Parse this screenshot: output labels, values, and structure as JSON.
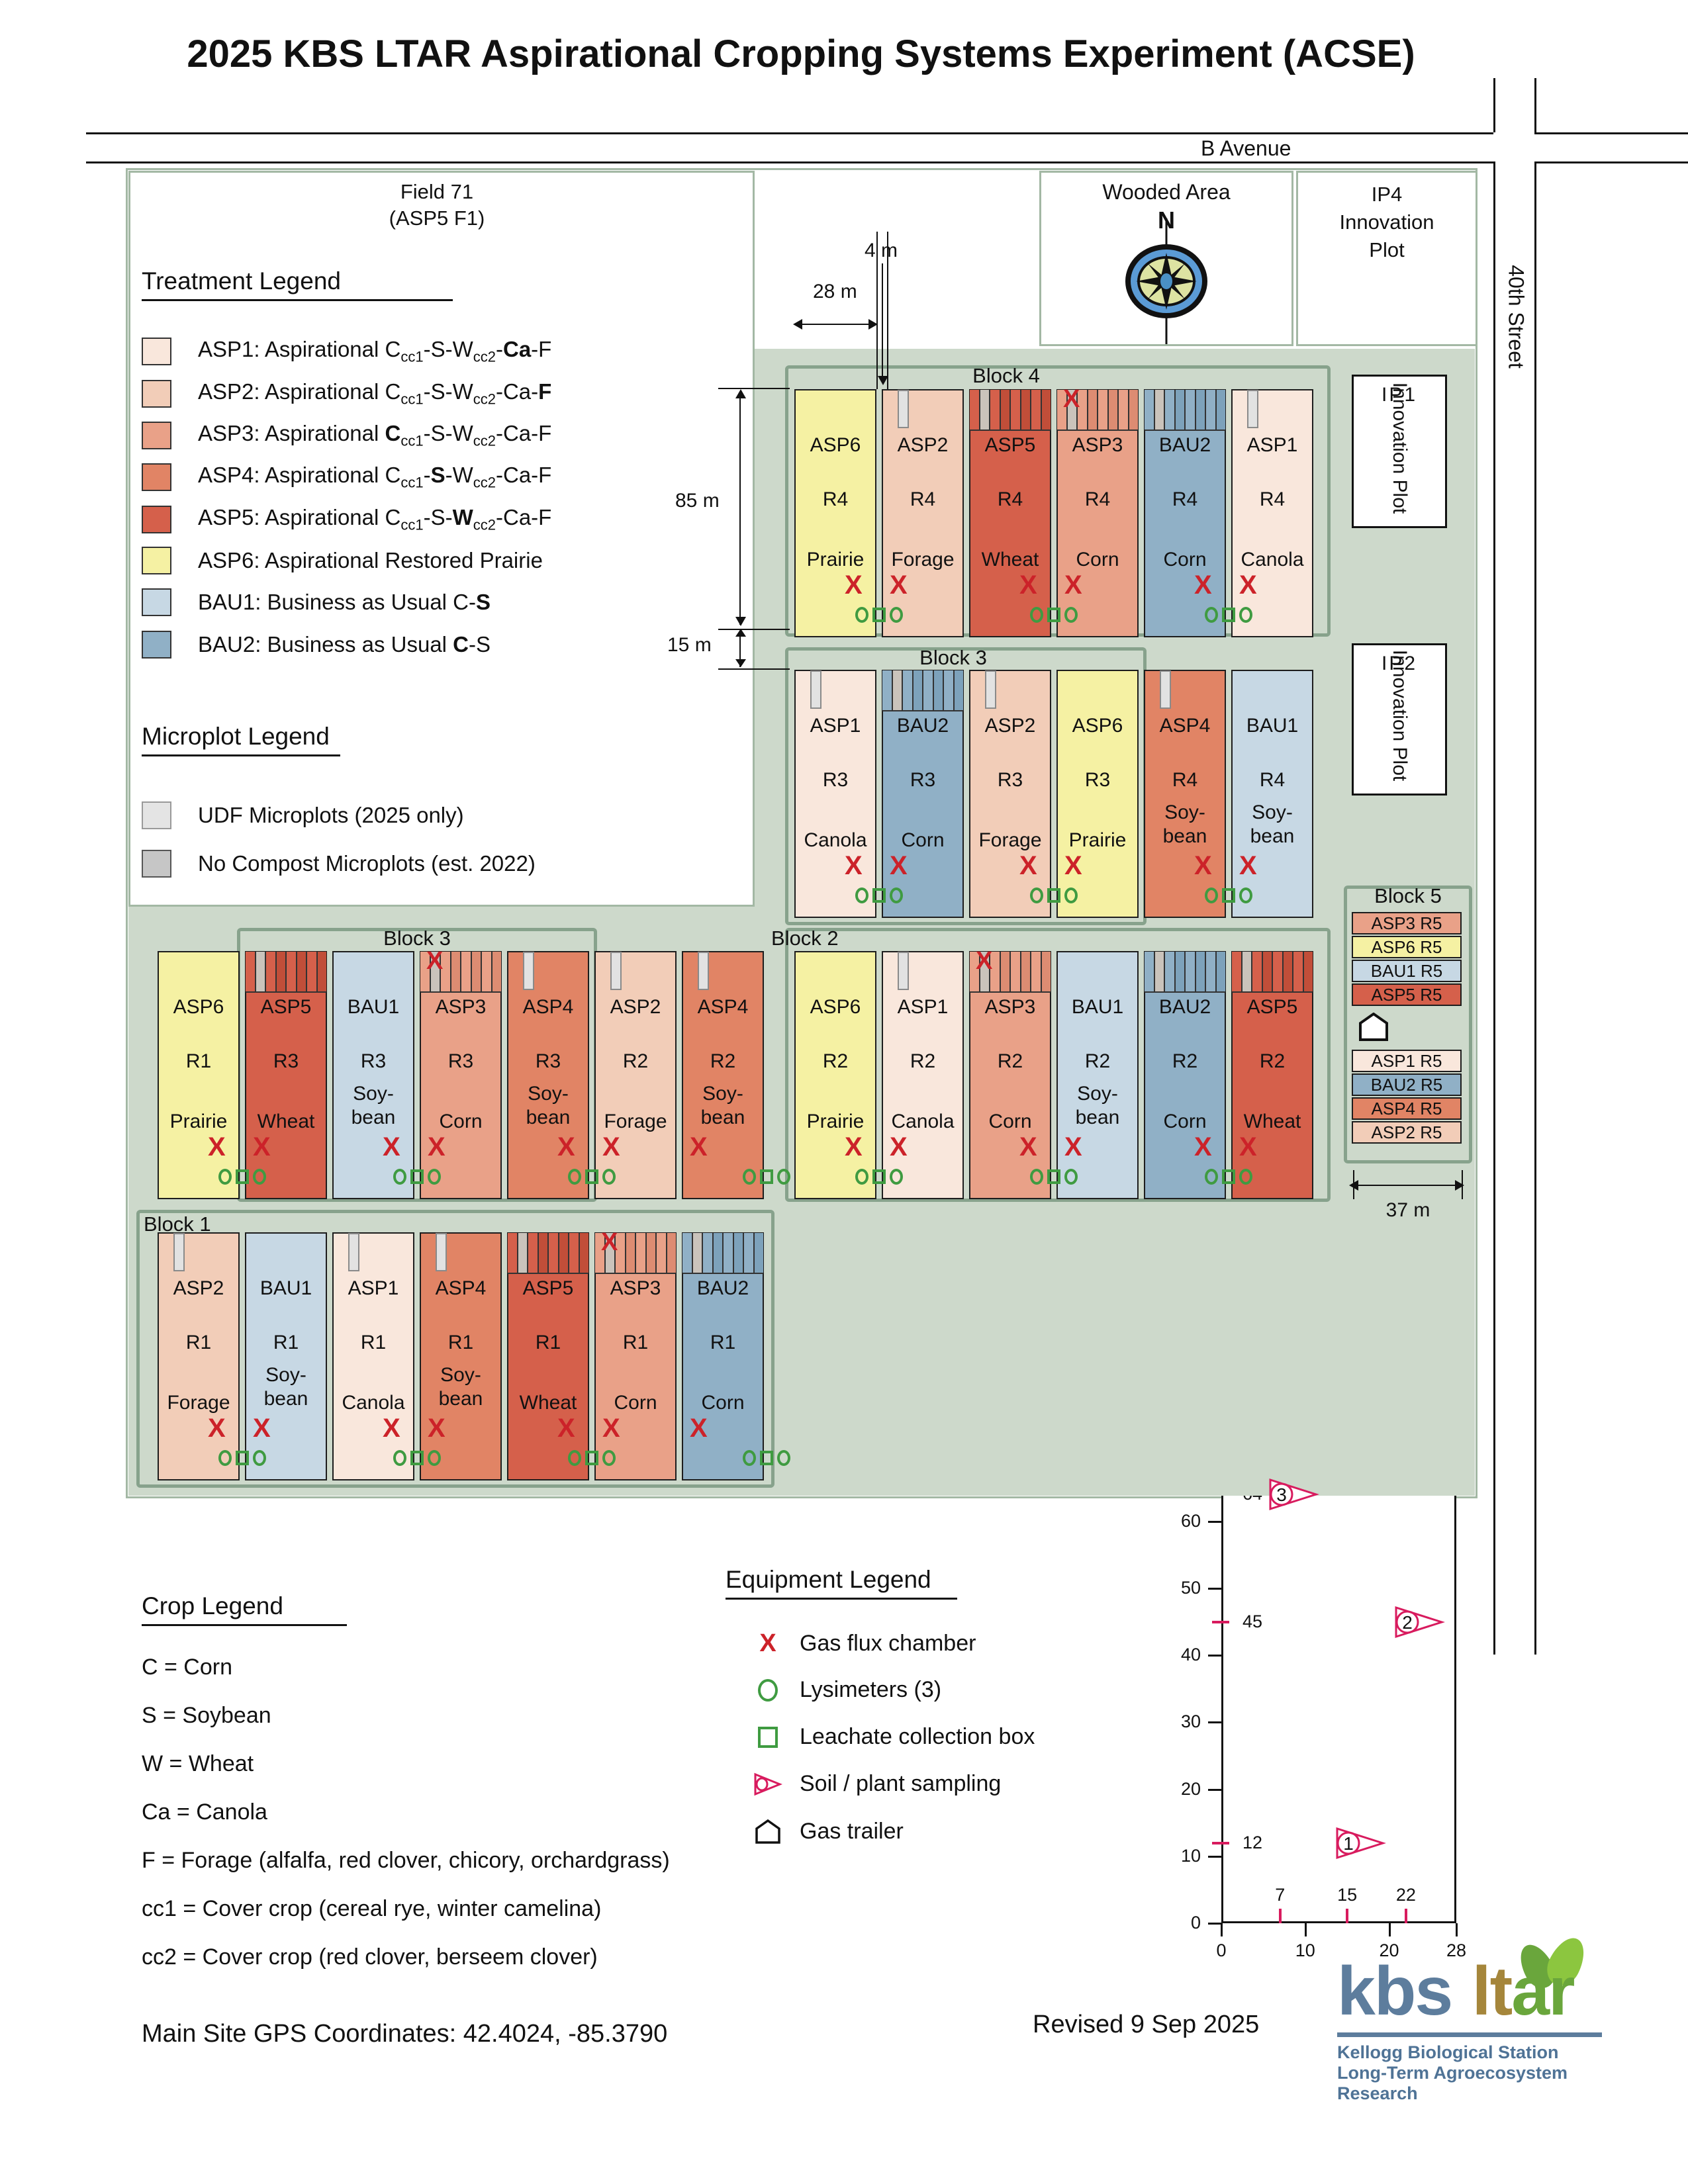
{
  "title": "2025 KBS LTAR Aspirational Cropping Systems Experiment (ACSE)",
  "roads": {
    "b_avenue": "B Avenue",
    "street": "40th Street"
  },
  "field": {
    "name_line1": "Field 71",
    "name_line2": "(ASP5 F1)"
  },
  "wooded_area": {
    "label": "Wooded Area",
    "north": "N"
  },
  "ip4": {
    "lines": [
      "IP4",
      "Innovation",
      "Plot"
    ]
  },
  "ip1": {
    "code": "IP1",
    "label": "Innovation Plot"
  },
  "ip2": {
    "code": "IP2",
    "label": "Innovation Plot"
  },
  "dimensions": {
    "d4": "4 m",
    "d28": "28 m",
    "d85": "85 m",
    "d15": "15 m",
    "d37": "37 m"
  },
  "block_labels": {
    "block4": "Block 4",
    "block3_upper": "Block 3",
    "block3_lower": "Block 3",
    "block2": "Block 2",
    "block1": "Block 1",
    "block5": "Block 5"
  },
  "treatments": {
    "ASP1": {
      "color": "#f9e7dc",
      "dark": "#ecd2c4"
    },
    "ASP2": {
      "color": "#f2cdb8",
      "dark": "#e3b79e"
    },
    "ASP3": {
      "color": "#e9a188",
      "dark": "#dd8c72"
    },
    "ASP4": {
      "color": "#e18465",
      "dark": "#d57253"
    },
    "ASP5": {
      "color": "#d5604b",
      "dark": "#c14e39"
    },
    "ASP6": {
      "color": "#f5f1a3",
      "dark": "#e8e38c"
    },
    "BAU1": {
      "color": "#c7d8e4",
      "dark": "#b3c8d8"
    },
    "BAU2": {
      "color": "#90b0c6",
      "dark": "#7da2bb"
    }
  },
  "treatment_legend": {
    "heading": "Treatment Legend",
    "entries": [
      {
        "code": "ASP1",
        "parts": [
          {
            "t": "ASP1: Aspirational C"
          },
          {
            "t": "cc1",
            "sub": true
          },
          {
            "t": "-S-W"
          },
          {
            "t": "cc2",
            "sub": true
          },
          {
            "t": "-"
          },
          {
            "t": "Ca",
            "b": true
          },
          {
            "t": "-F"
          }
        ]
      },
      {
        "code": "ASP2",
        "parts": [
          {
            "t": "ASP2: Aspirational C"
          },
          {
            "t": "cc1",
            "sub": true
          },
          {
            "t": "-S-W"
          },
          {
            "t": "cc2",
            "sub": true
          },
          {
            "t": "-Ca-"
          },
          {
            "t": "F",
            "b": true
          }
        ]
      },
      {
        "code": "ASP3",
        "parts": [
          {
            "t": "ASP3: Aspirational "
          },
          {
            "t": "C",
            "b": true
          },
          {
            "t": "cc1",
            "sub": true
          },
          {
            "t": "-S-W"
          },
          {
            "t": "cc2",
            "sub": true
          },
          {
            "t": "-Ca-F"
          }
        ]
      },
      {
        "code": "ASP4",
        "parts": [
          {
            "t": "ASP4: Aspirational C"
          },
          {
            "t": "cc1",
            "sub": true
          },
          {
            "t": "-"
          },
          {
            "t": "S",
            "b": true
          },
          {
            "t": "-W"
          },
          {
            "t": "cc2",
            "sub": true
          },
          {
            "t": "-Ca-F"
          }
        ]
      },
      {
        "code": "ASP5",
        "parts": [
          {
            "t": "ASP5: Aspirational C"
          },
          {
            "t": "cc1",
            "sub": true
          },
          {
            "t": "-S-"
          },
          {
            "t": "W",
            "b": true
          },
          {
            "t": "cc2",
            "sub": true
          },
          {
            "t": "-Ca-F"
          }
        ]
      },
      {
        "code": "ASP6",
        "parts": [
          {
            "t": "ASP6: Aspirational Restored Prairie"
          }
        ]
      },
      {
        "code": "BAU1",
        "parts": [
          {
            "t": "BAU1: Business as Usual C-"
          },
          {
            "t": "S",
            "b": true
          }
        ]
      },
      {
        "code": "BAU2",
        "parts": [
          {
            "t": "BAU2: Business as Usual "
          },
          {
            "t": "C",
            "b": true
          },
          {
            "t": "-S"
          }
        ]
      }
    ]
  },
  "microplot_legend": {
    "heading": "Microplot Legend",
    "entries": [
      {
        "label": "UDF Microplots (2025 only)",
        "color": "#e4e4e4",
        "border": "#999999"
      },
      {
        "label": "No Compost Microplots (est. 2022)",
        "color": "#c6c6c6",
        "border": "#555555"
      }
    ]
  },
  "crop_legend": {
    "heading": "Crop Legend",
    "entries": [
      "C = Corn",
      "S = Soybean",
      "W = Wheat",
      "Ca = Canola",
      "F = Forage (alfalfa, red clover, chicory, orchardgrass)",
      "cc1 = Cover crop (cereal rye, winter camelina)",
      "cc2 = Cover crop (red clover, berseem clover)"
    ]
  },
  "equipment_legend": {
    "heading": "Equipment Legend",
    "entries": [
      {
        "icon": "gas-flux-x-icon",
        "label": "Gas flux chamber"
      },
      {
        "icon": "lysimeter-icon",
        "label": "Lysimeters (3)"
      },
      {
        "icon": "leachate-box-icon",
        "label": "Leachate collection box"
      },
      {
        "icon": "soil-plant-sampling-icon",
        "label": "Soil / plant sampling"
      },
      {
        "icon": "gas-trailer-icon",
        "label": "Gas trailer"
      }
    ]
  },
  "layout": {
    "rows": [
      {
        "top": 588,
        "start": 1200,
        "plots": [
          {
            "code": "ASP6",
            "rep": "R4",
            "crop": [
              "Prairie"
            ],
            "tab": "none",
            "x": "right",
            "sym": true
          },
          {
            "code": "ASP2",
            "rep": "R4",
            "crop": [
              "Forage"
            ],
            "tab": "udf",
            "x": "left",
            "sym": false
          },
          {
            "code": "ASP5",
            "rep": "R4",
            "crop": [
              "Wheat"
            ],
            "tab": "stripes",
            "x": "right",
            "sym": true
          },
          {
            "code": "ASP3",
            "rep": "R4",
            "crop": [
              "Corn"
            ],
            "tab": "stripes-x",
            "x": "left",
            "sym": false
          },
          {
            "code": "BAU2",
            "rep": "R4",
            "crop": [
              "Corn"
            ],
            "tab": "stripes",
            "x": "right",
            "sym": true
          },
          {
            "code": "ASP1",
            "rep": "R4",
            "crop": [
              "Canola"
            ],
            "tab": "udf",
            "x": "left",
            "sym": false
          }
        ]
      },
      {
        "top": 1012,
        "start": 1200,
        "plots": [
          {
            "code": "ASP1",
            "rep": "R3",
            "crop": [
              "Canola"
            ],
            "tab": "udf",
            "x": "right",
            "sym": true
          },
          {
            "code": "BAU2",
            "rep": "R3",
            "crop": [
              "Corn"
            ],
            "tab": "stripes",
            "x": "left",
            "sym": false
          },
          {
            "code": "ASP2",
            "rep": "R3",
            "crop": [
              "Forage"
            ],
            "tab": "udf",
            "x": "right",
            "sym": true
          },
          {
            "code": "ASP6",
            "rep": "R3",
            "crop": [
              "Prairie"
            ],
            "tab": "none",
            "x": "left",
            "sym": false
          },
          {
            "code": "ASP4",
            "rep": "R4",
            "crop": [
              "Soy-",
              "bean"
            ],
            "tab": "udf",
            "x": "right",
            "sym": true
          },
          {
            "code": "BAU1",
            "rep": "R4",
            "crop": [
              "Soy-",
              "bean"
            ],
            "tab": "none",
            "x": "left",
            "sym": false
          }
        ]
      },
      {
        "top": 1437,
        "start": 238,
        "plots": [
          {
            "code": "ASP6",
            "rep": "R1",
            "crop": [
              "Prairie"
            ],
            "tab": "none",
            "x": "right",
            "sym": true
          },
          {
            "code": "ASP5",
            "rep": "R3",
            "crop": [
              "Wheat"
            ],
            "tab": "stripes",
            "x": "left",
            "sym": false
          },
          {
            "code": "BAU1",
            "rep": "R3",
            "crop": [
              "Soy-",
              "bean"
            ],
            "tab": "none",
            "x": "right",
            "sym": true
          },
          {
            "code": "ASP3",
            "rep": "R3",
            "crop": [
              "Corn"
            ],
            "tab": "stripes-x",
            "x": "left",
            "sym": false
          },
          {
            "code": "ASP4",
            "rep": "R3",
            "crop": [
              "Soy-",
              "bean"
            ],
            "tab": "udf",
            "x": "right",
            "sym": true
          },
          {
            "code": "ASP2",
            "rep": "R2",
            "crop": [
              "Forage"
            ],
            "tab": "udf",
            "x": "left",
            "sym": false
          },
          {
            "code": "ASP4",
            "rep": "R2",
            "crop": [
              "Soy-",
              "bean"
            ],
            "tab": "udf",
            "x": "left",
            "sym": true
          }
        ]
      },
      {
        "top": 1437,
        "start": 1200,
        "plots": [
          {
            "code": "ASP6",
            "rep": "R2",
            "crop": [
              "Prairie"
            ],
            "tab": "none",
            "x": "right",
            "sym": true
          },
          {
            "code": "ASP1",
            "rep": "R2",
            "crop": [
              "Canola"
            ],
            "tab": "udf",
            "x": "left",
            "sym": false
          },
          {
            "code": "ASP3",
            "rep": "R2",
            "crop": [
              "Corn"
            ],
            "tab": "stripes-x",
            "x": "right",
            "sym": true
          },
          {
            "code": "BAU1",
            "rep": "R2",
            "crop": [
              "Soy-",
              "bean"
            ],
            "tab": "none",
            "x": "left",
            "sym": false
          },
          {
            "code": "BAU2",
            "rep": "R2",
            "crop": [
              "Corn"
            ],
            "tab": "stripes",
            "x": "right",
            "sym": true
          },
          {
            "code": "ASP5",
            "rep": "R2",
            "crop": [
              "Wheat"
            ],
            "tab": "stripes",
            "x": "left",
            "sym": false
          }
        ]
      },
      {
        "top": 1862,
        "start": 238,
        "plots": [
          {
            "code": "ASP2",
            "rep": "R1",
            "crop": [
              "Forage"
            ],
            "tab": "udf",
            "x": "right",
            "sym": true
          },
          {
            "code": "BAU1",
            "rep": "R1",
            "crop": [
              "Soy-",
              "bean"
            ],
            "tab": "none",
            "x": "left",
            "sym": false
          },
          {
            "code": "ASP1",
            "rep": "R1",
            "crop": [
              "Canola"
            ],
            "tab": "udf",
            "x": "right",
            "sym": true
          },
          {
            "code": "ASP4",
            "rep": "R1",
            "crop": [
              "Soy-",
              "bean"
            ],
            "tab": "udf",
            "x": "left",
            "sym": false
          },
          {
            "code": "ASP5",
            "rep": "R1",
            "crop": [
              "Wheat"
            ],
            "tab": "stripes",
            "x": "right",
            "sym": true
          },
          {
            "code": "ASP3",
            "rep": "R1",
            "crop": [
              "Corn"
            ],
            "tab": "stripes-x",
            "x": "left",
            "sym": false
          },
          {
            "code": "BAU2",
            "rep": "R1",
            "crop": [
              "Corn"
            ],
            "tab": "stripes",
            "x": "left",
            "sym": true
          }
        ]
      }
    ]
  },
  "block5": {
    "strips_top": [
      "ASP3 R5",
      "ASP6 R5",
      "BAU1 R5",
      "ASP5 R5"
    ],
    "strips_bottom": [
      "ASP1 R5",
      "BAU2 R5",
      "ASP4 R5",
      "ASP2 R5"
    ]
  },
  "sampling_map": {
    "title": "Sampling Station Map",
    "microplots_label": "Microplots",
    "type": "scatter",
    "xlim": [
      0,
      28
    ],
    "ylim": [
      0,
      85
    ],
    "band": [
      75,
      85
    ],
    "y_ticks": [
      85,
      80,
      75,
      70,
      60,
      50,
      40,
      30,
      20,
      10,
      0
    ],
    "y_station_ticks": [
      64,
      45,
      12
    ],
    "x_ticks": [
      0,
      10,
      20,
      28
    ],
    "x_station_ticks": [
      7,
      15,
      22
    ],
    "stations": [
      {
        "n": "3",
        "x": 7,
        "y": 64
      },
      {
        "n": "2",
        "x": 22,
        "y": 45
      },
      {
        "n": "1",
        "x": 15,
        "y": 12
      }
    ]
  },
  "footer": {
    "gps": "Main Site GPS Coordinates: 42.4024, -85.3790",
    "revised": "Revised 9 Sep 2025",
    "logo": {
      "kbs": "kbs",
      "lt": "lt",
      "ar": "ar",
      "line1": "Kellogg Biological Station",
      "line2": "Long-Term Agroecosystem Research"
    }
  },
  "marker_colors": {
    "x": "#cc2229",
    "green": "#3f9b41",
    "pink": "#d81b5e",
    "udf": "#e2e2e2",
    "no_compost": "#c6c6c6",
    "stripe_gray": "#cac3bb"
  }
}
